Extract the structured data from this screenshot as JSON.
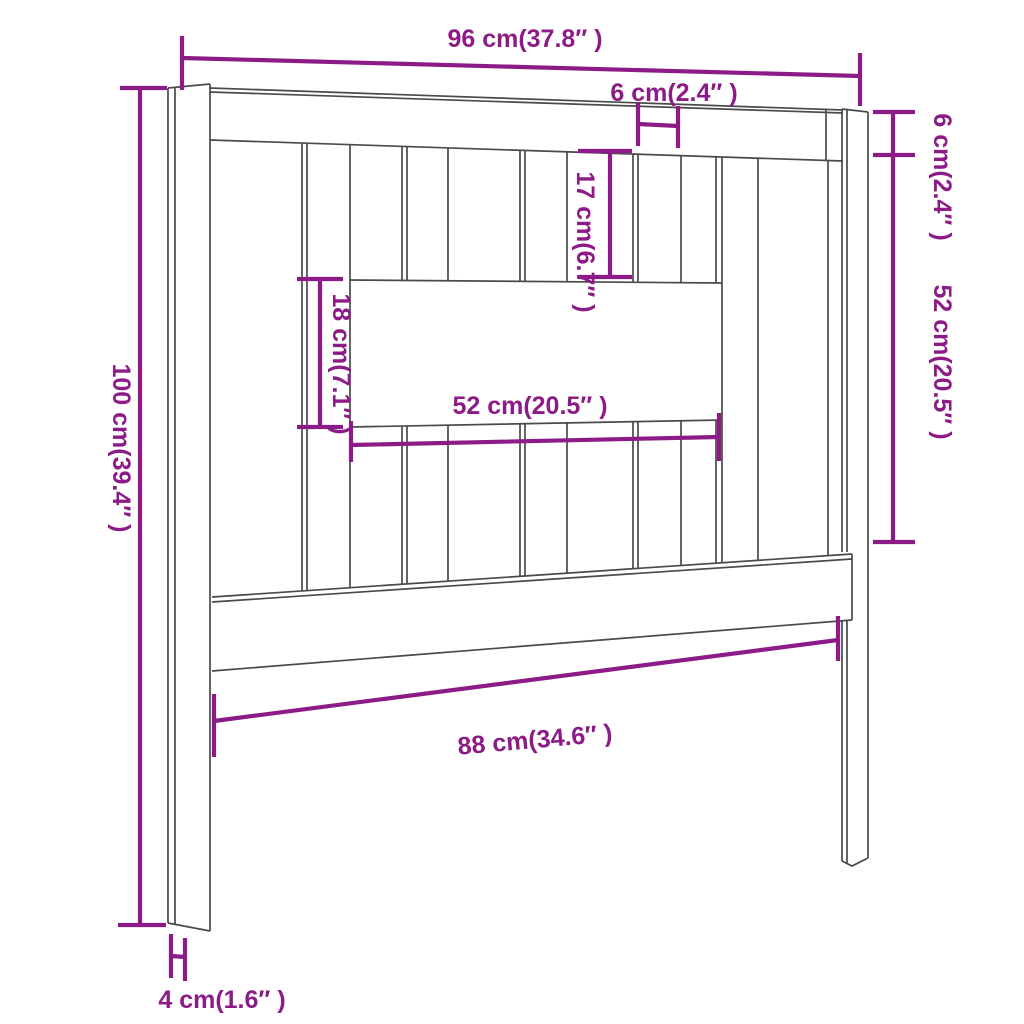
{
  "diagram": {
    "type": "furniture-dimension-diagram",
    "subject": "bed headboard wireframe with dimension callouts",
    "colors": {
      "dimension_purple": "#8D1B87",
      "outline_gray": "#4A4A4A",
      "background": "#FFFFFF"
    },
    "labels": {
      "overall_width": "96 cm(37.8″ )",
      "slat_gap": "6 cm(2.4″ )",
      "top_rail_height": "6 cm(2.4″ )",
      "upper_slat_height": "17 cm(6.7″ )",
      "opening_height": "18 cm(7.1″ )",
      "opening_width": "52 cm(20.5″ )",
      "side_panel_height": "52 cm(20.5″ )",
      "total_height": "100 cm(39.4″ )",
      "lower_inner_width": "88 cm(34.6″ )",
      "leg_width": "4 cm(1.6″ )"
    },
    "measurements": [
      {
        "name": "overall width",
        "cm": 96,
        "inch": 37.8
      },
      {
        "name": "slat gap",
        "cm": 6,
        "inch": 2.4
      },
      {
        "name": "top rail height",
        "cm": 6,
        "inch": 2.4
      },
      {
        "name": "upper slat height",
        "cm": 17,
        "inch": 6.7
      },
      {
        "name": "opening height",
        "cm": 18,
        "inch": 7.1
      },
      {
        "name": "opening width",
        "cm": 52,
        "inch": 20.5
      },
      {
        "name": "side panel height",
        "cm": 52,
        "inch": 20.5
      },
      {
        "name": "total height",
        "cm": 100,
        "inch": 39.4
      },
      {
        "name": "lower inner width",
        "cm": 88,
        "inch": 34.6
      },
      {
        "name": "leg width",
        "cm": 4,
        "inch": 1.6
      }
    ]
  }
}
